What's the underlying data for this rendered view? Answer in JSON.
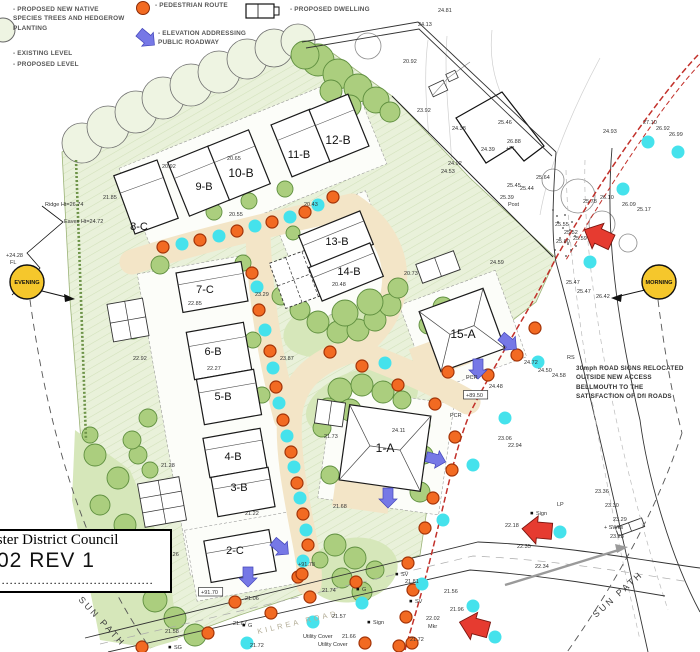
{
  "legend": {
    "planting": "- PROPOSED NEW NATIVE\nSPECIES TREES AND HEDGEROW\nPLANTING",
    "existing_level": "- EXISTING LEVEL",
    "proposed_level": "- PROPOSED LEVEL",
    "pedestrian_route": "- PEDESTRIAN ROUTE",
    "elevation_addressing": "- ELEVATION ADDRESSING\nPUBLIC ROADWAY",
    "proposed_dwelling": "- PROPOSED DWELLING"
  },
  "title_block": {
    "council": "Mid Ulster District Council",
    "drawing_label": "Drawing",
    "revision": "02 REV 1",
    "number_label": "Number......................................."
  },
  "sun": {
    "evening": "EVENING",
    "morning": "MORNING",
    "sun_path": "SUN PATH"
  },
  "road_name": "KILREA ROAD",
  "note_road_signs": "30mph ROAD SIGNS\nRELOCATED OUTSIDE\nNEW ACCESS BELLMOUTH\nTO THE SATISFACTION\nOF DfI ROADS",
  "colors": {
    "orange": "#f26a22",
    "cyan": "#45e2ec",
    "blue_arrow": "#7678e6",
    "red": "#e63b30",
    "sun_yellow": "#f5c72c",
    "red_dash": "#c2302a",
    "site_green": "#e9f1da",
    "tree_green": "#abce7e",
    "road_beige": "#f3e5c7"
  },
  "plots": [
    {
      "id": "8-C"
    },
    {
      "id": "9-B"
    },
    {
      "id": "10-B"
    },
    {
      "id": "11-B"
    },
    {
      "id": "12-B"
    },
    {
      "id": "13-B"
    },
    {
      "id": "14-B"
    },
    {
      "id": "7-C"
    },
    {
      "id": "6-B"
    },
    {
      "id": "5-B"
    },
    {
      "id": "4-B"
    },
    {
      "id": "3-B"
    },
    {
      "id": "2-C"
    },
    {
      "id": "1-A"
    },
    {
      "id": "15-A"
    }
  ],
  "annotations": [
    {
      "t": "24.13",
      "x": 418,
      "y": 26
    },
    {
      "t": "24.81",
      "x": 438,
      "y": 12
    },
    {
      "t": "20.92",
      "x": 403,
      "y": 63
    },
    {
      "t": "23.92",
      "x": 417,
      "y": 112
    },
    {
      "t": "24.38",
      "x": 452,
      "y": 130
    },
    {
      "t": "24.39",
      "x": 481,
      "y": 151
    },
    {
      "t": "25.46",
      "x": 498,
      "y": 124
    },
    {
      "t": "24.92",
      "x": 448,
      "y": 165
    },
    {
      "t": "24.53",
      "x": 441,
      "y": 173
    },
    {
      "t": "26.88",
      "x": 507,
      "y": 143
    },
    {
      "t": "+FL",
      "x": 506,
      "y": 150
    },
    {
      "t": "25.45",
      "x": 507,
      "y": 187
    },
    {
      "t": "25.44",
      "x": 520,
      "y": 190
    },
    {
      "t": "25.64",
      "x": 536,
      "y": 179
    },
    {
      "t": "25.39",
      "x": 500,
      "y": 199
    },
    {
      "t": "Post",
      "x": 508,
      "y": 206,
      "s": "f"
    },
    {
      "t": "24.59",
      "x": 490,
      "y": 264
    },
    {
      "t": "27.10",
      "x": 643,
      "y": 124
    },
    {
      "t": "26.92",
      "x": 656,
      "y": 130
    },
    {
      "t": "26.99",
      "x": 669,
      "y": 136
    },
    {
      "t": "24.93",
      "x": 603,
      "y": 133
    },
    {
      "t": "26.10",
      "x": 600,
      "y": 199
    },
    {
      "t": "25.78",
      "x": 583,
      "y": 203
    },
    {
      "t": "26.09",
      "x": 622,
      "y": 206
    },
    {
      "t": "25.17",
      "x": 637,
      "y": 211
    },
    {
      "t": "25.55",
      "x": 555,
      "y": 226
    },
    {
      "t": "25.52",
      "x": 564,
      "y": 234
    },
    {
      "t": "25.59",
      "x": 573,
      "y": 240
    },
    {
      "t": "25.60",
      "x": 556,
      "y": 243
    },
    {
      "t": "25.47",
      "x": 566,
      "y": 284
    },
    {
      "t": "25.47",
      "x": 577,
      "y": 293
    },
    {
      "t": "26.42",
      "x": 596,
      "y": 298
    },
    {
      "t": "24.72",
      "x": 524,
      "y": 364
    },
    {
      "t": "24.50",
      "x": 538,
      "y": 372
    },
    {
      "t": "24.58",
      "x": 552,
      "y": 377
    },
    {
      "t": "24.48",
      "x": 489,
      "y": 388
    },
    {
      "t": "RS",
      "x": 567,
      "y": 359,
      "s": "f"
    },
    {
      "t": "23.06",
      "x": 498,
      "y": 440
    },
    {
      "t": "22.94",
      "x": 508,
      "y": 447
    },
    {
      "t": "24.11",
      "x": 392,
      "y": 432
    },
    {
      "t": "21.73",
      "x": 324,
      "y": 438
    },
    {
      "t": "21.68",
      "x": 333,
      "y": 508
    },
    {
      "t": "20.65",
      "x": 227,
      "y": 160
    },
    {
      "t": "20.92",
      "x": 162,
      "y": 168
    },
    {
      "t": "20.43",
      "x": 304,
      "y": 206
    },
    {
      "t": "20.55",
      "x": 229,
      "y": 216
    },
    {
      "t": "21.85",
      "x": 103,
      "y": 199
    },
    {
      "t": "22.85",
      "x": 188,
      "y": 305
    },
    {
      "t": "22.27",
      "x": 207,
      "y": 370
    },
    {
      "t": "23.29",
      "x": 255,
      "y": 296
    },
    {
      "t": "23.87",
      "x": 280,
      "y": 360
    },
    {
      "t": "22.92",
      "x": 133,
      "y": 360
    },
    {
      "t": "20.73",
      "x": 404,
      "y": 275
    },
    {
      "t": "20.48",
      "x": 332,
      "y": 286
    },
    {
      "t": "21.28",
      "x": 161,
      "y": 467
    },
    {
      "t": "21.22",
      "x": 245,
      "y": 515
    },
    {
      "t": "21.26",
      "x": 165,
      "y": 556
    },
    {
      "t": "+91.78",
      "x": 298,
      "y": 566
    },
    {
      "t": "22.18",
      "x": 505,
      "y": 527
    },
    {
      "t": "22.35",
      "x": 517,
      "y": 548
    },
    {
      "t": "22.34",
      "x": 535,
      "y": 568
    },
    {
      "t": "23.36",
      "x": 595,
      "y": 493
    },
    {
      "t": "23.30",
      "x": 605,
      "y": 507
    },
    {
      "t": "23.29",
      "x": 613,
      "y": 521
    },
    {
      "t": "+ SWks",
      "x": 604,
      "y": 529,
      "s": "f"
    },
    {
      "t": "23.28",
      "x": 610,
      "y": 538
    },
    {
      "t": "LP",
      "x": 557,
      "y": 506,
      "s": "f"
    },
    {
      "t": "Sign",
      "x": 536,
      "y": 515,
      "s": "m"
    },
    {
      "t": "21.06",
      "x": 245,
      "y": 600
    },
    {
      "t": "21.74",
      "x": 322,
      "y": 592
    },
    {
      "t": "21.67",
      "x": 233,
      "y": 625
    },
    {
      "t": "21.57",
      "x": 332,
      "y": 618
    },
    {
      "t": "21.66",
      "x": 342,
      "y": 638
    },
    {
      "t": "21.81",
      "x": 405,
      "y": 583
    },
    {
      "t": "21.56",
      "x": 444,
      "y": 593
    },
    {
      "t": "21.96",
      "x": 450,
      "y": 611
    },
    {
      "t": "22.02",
      "x": 426,
      "y": 620
    },
    {
      "t": "Mkr",
      "x": 428,
      "y": 628,
      "s": "f"
    },
    {
      "t": "Sign",
      "x": 373,
      "y": 624,
      "s": "m"
    },
    {
      "t": "SV",
      "x": 401,
      "y": 576,
      "s": "m"
    },
    {
      "t": "SV",
      "x": 415,
      "y": 603,
      "s": "m"
    },
    {
      "t": "G",
      "x": 362,
      "y": 591,
      "s": "m"
    },
    {
      "t": "G",
      "x": 248,
      "y": 627,
      "s": "m"
    },
    {
      "t": "Utility Cover",
      "x": 303,
      "y": 638,
      "s": "f"
    },
    {
      "t": "Utility Cover",
      "x": 318,
      "y": 646,
      "s": "f"
    },
    {
      "t": "21.72",
      "x": 250,
      "y": 647
    },
    {
      "t": "21.72",
      "x": 410,
      "y": 641
    },
    {
      "t": "21.58",
      "x": 165,
      "y": 633
    },
    {
      "t": "SG",
      "x": 174,
      "y": 649,
      "s": "m"
    },
    {
      "t": "+24.28",
      "x": 6,
      "y": 257
    },
    {
      "t": "FL",
      "x": 10,
      "y": 264
    },
    {
      "t": "Ridge Ht=26.74",
      "x": 45,
      "y": 206
    },
    {
      "t": "Eaves Ht=24.72",
      "x": 64,
      "y": 223
    },
    {
      "t": "PCR",
      "x": 466,
      "y": 379,
      "s": "f"
    },
    {
      "t": "PCR",
      "x": 450,
      "y": 417,
      "s": "f"
    },
    {
      "t": "+89.50",
      "x": 466,
      "y": 397,
      "s": "b"
    },
    {
      "t": "+91.70",
      "x": 201,
      "y": 594,
      "s": "b"
    }
  ]
}
